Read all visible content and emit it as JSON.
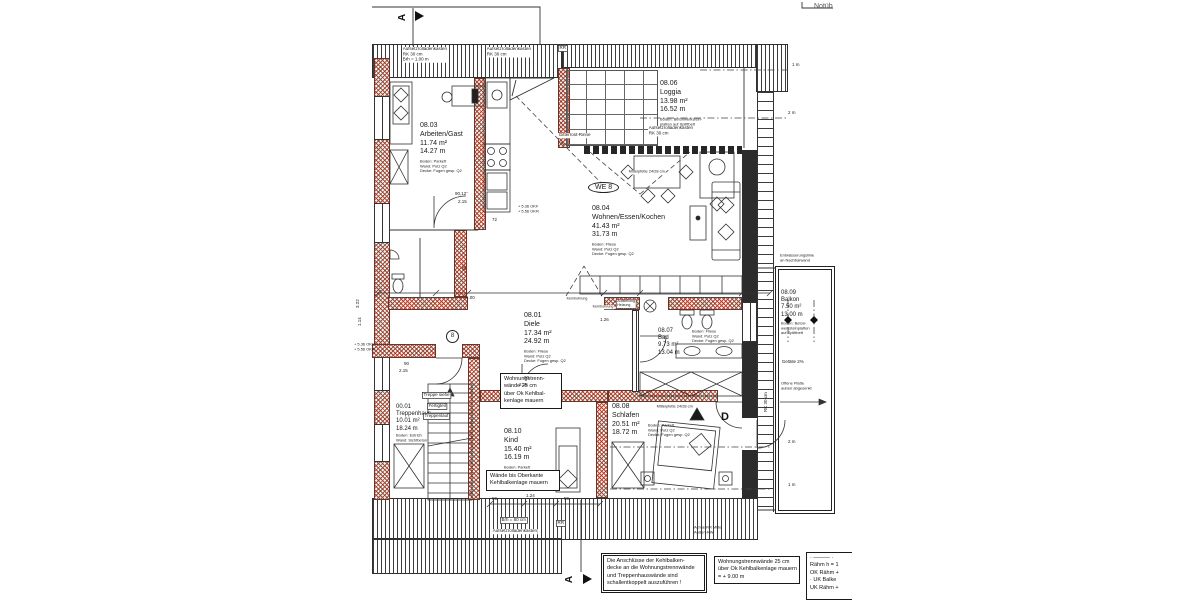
{
  "doc": {
    "notub": "Notüb"
  },
  "unit_label": "WE 8",
  "rooms": [
    {
      "id": "08.03",
      "name": "Arbeiten/Gast",
      "area": "11.74 m²",
      "perim": "14.27 m",
      "f1": "Boden: Parkett",
      "f2": "Wand: Putz Q2",
      "f3": "Decke: Fugen gesp. Q2"
    },
    {
      "id": "08.06",
      "name": "Loggia",
      "area": "13.98 m²",
      "perim": "16.52 m",
      "f1": "Boden: Betonwerkstein-",
      "f2": "platten auf Splittbett",
      "f3": ""
    },
    {
      "id": "08.04",
      "name": "Wohnen/Essen/Kochen",
      "area": "41.43 m²",
      "perim": "31.73 m",
      "f1": "Boden: Fliese",
      "f2": "Wand: Putz Q2",
      "f3": "Decke: Fugen gesp. Q2"
    },
    {
      "id": "08.01",
      "name": "Diele",
      "area": "17.34 m²",
      "perim": "24.92 m",
      "f1": "Boden: Fliese",
      "f2": "Wand: Putz Q2",
      "f3": "Decke: Fugen gesp. Q2"
    },
    {
      "id": "08.07",
      "name": "Bad",
      "area": "9.73 m²",
      "perim": "13.04 m",
      "f1": "Boden: Fliese",
      "f2": "Wand: Putz Q2",
      "f3": "Decke: Fugen gesp. Q2"
    },
    {
      "id": "08.08",
      "name": "Schlafen",
      "area": "20.51 m²",
      "perim": "18.72 m",
      "f1": "Boden: Parkett",
      "f2": "Wand: Putz Q2",
      "f3": "Decke: Fugen gesp. Q2"
    },
    {
      "id": "08.10",
      "name": "Kind",
      "area": "15.40 m²",
      "perim": "16.19 m",
      "f1": "Boden: Parkett",
      "f2": "Wand: Putz Q2",
      "f3": "Decke: Fugen gesp. Q2"
    },
    {
      "id": "00.01",
      "name": "Treppenhaus",
      "area": "10.01 m²",
      "perim": "18.24 m",
      "f1": "Boden: Estrich",
      "f2": "Wand: Sichtbeton",
      "f3": ""
    },
    {
      "id": "08.09",
      "name": "Balkon",
      "area": "7.50 m²",
      "perim": "13.00 m",
      "f1": "Boden: Beton-",
      "f2": "werksteinplatten",
      "f3": "auf Splittbett"
    }
  ],
  "notes": {
    "trennwand": [
      "Wohnungstrenn-",
      "wände 25 cm",
      "über Ok Kehlbal-",
      "kenlage mauern"
    ],
    "waende": [
      "Wände bis Oberkante",
      "Kehlbalkenlage mauern"
    ],
    "box1": [
      "Die Anschlüsse der Kehlbalken-",
      "decke an die Wohnungstrennwände",
      "und Treppenhauswände sind",
      "schallentkoppelt auszuführen !"
    ],
    "box2": [
      "Wohnungstrennwände 25 cm",
      "über Ok Kehlbalkenlage mauern",
      "= + 9.00 m"
    ],
    "box3": [
      "· ——— ·",
      "Rähm h = 1",
      "OK Rähm +",
      "· UK Balke",
      "UK Rähm +"
    ]
  },
  "labels": {
    "rollladen": "Aufsetzrolladenkasten",
    "rk30": "RK 30 cm",
    "brh100": "Brh = 1.00 m",
    "brh80": "Brh = 80 cm",
    "rr": "RR",
    "gitterrost": "Gitterrost-Rinne",
    "mittelpfette": "Mittelpfette 24/28 cm",
    "gefaelle": "Gefälle 2%",
    "offene1": "Offene Platte",
    "offene2": "außen abgesenkt",
    "entw1": "Entwässerungslinie",
    "entw2": "an Nachbarwand",
    "achse1": "Achse RR Mitte",
    "achse2": "Außen-RW",
    "okf": "+ 5.36 OKF",
    "okr": "+ 5.56 OKR",
    "treppe1": "Treppe siehe",
    "treppe2": "Fertigteil",
    "treppe3": "Treppenlauf",
    "kernbohrung": "Kernbohrung",
    "heizung1": "Aufstellung",
    "heizung2": "Heizung"
  },
  "markers": {
    "section": "A",
    "b": "B",
    "d": "D",
    "eight": "8"
  },
  "scale": {
    "m1": "1 m",
    "m2": "2 m"
  },
  "dims": {
    "d1": "2.15",
    "d2": "90,12°",
    "d3": "72",
    "d4": "1.00",
    "d5": "1.26",
    "d6": "90",
    "d7": "2.15",
    "d8": "59",
    "d9": "1.24",
    "d10": "59",
    "d11": "90",
    "d12": "2.15",
    "d13": "1.14",
    "d14": "3.22"
  }
}
